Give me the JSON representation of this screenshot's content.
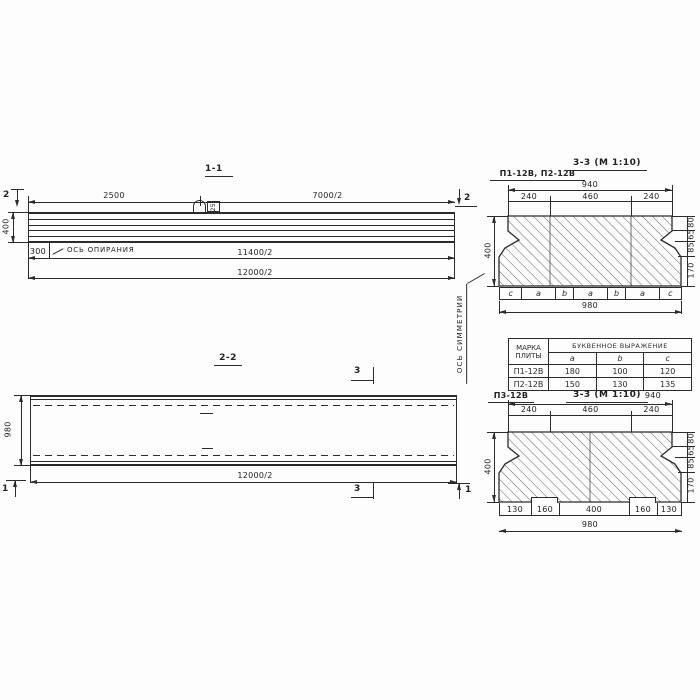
{
  "sections": {
    "s11": {
      "title": "1-1",
      "dim_2500": "2500",
      "dim_7000": "7000/2",
      "dim_400": "400",
      "dim_300": "300",
      "dim_11400": "11400/2",
      "dim_12000": "12000/2",
      "bearing_axis": "ОСЬ ОПИРАНИЯ",
      "cut_marker": "2",
      "loop_label": "25"
    },
    "s22": {
      "title": "2-2",
      "dim_980": "980",
      "dim_12000": "12000/2",
      "cut_marker_3": "3",
      "cut_marker_1": "1"
    },
    "symmetry_axis": "ОСЬ СИММЕТРИИ",
    "s33top": {
      "label": "П1-12В, П2-12В",
      "title": "3-3 (М 1:10)",
      "dim_940": "940",
      "segments": [
        "240",
        "460",
        "240"
      ],
      "dim_400": "400",
      "right_dims": [
        "80",
        "65",
        "85",
        "170"
      ],
      "letters": [
        "c",
        "a",
        "b",
        "a",
        "b",
        "a",
        "c"
      ],
      "dim_980": "980"
    },
    "s33bottom": {
      "label": "П3-12В",
      "title": "3-3 (М 1:10)",
      "dim_940": "940",
      "segments": [
        "240",
        "460",
        "240"
      ],
      "dim_400": "400",
      "right_dims": [
        "80",
        "65",
        "85",
        "170"
      ],
      "bottom_segments": [
        "130",
        "160",
        "400",
        "160",
        "130"
      ],
      "dim_980": "980"
    }
  },
  "table": {
    "header_col1": [
      "МАРКА",
      "ПЛИТЫ"
    ],
    "header_span": "БУКВЕННОЕ ВЫРАЖЕНИЕ",
    "columns": [
      "a",
      "b",
      "c"
    ],
    "rows": [
      {
        "mark": "П1-12В",
        "a": "180",
        "b": "100",
        "c": "120"
      },
      {
        "mark": "П2-12В",
        "a": "150",
        "b": "130",
        "c": "135"
      }
    ]
  },
  "colors": {
    "ink": "#2b2b2b",
    "paper": "#fdfdfd"
  }
}
